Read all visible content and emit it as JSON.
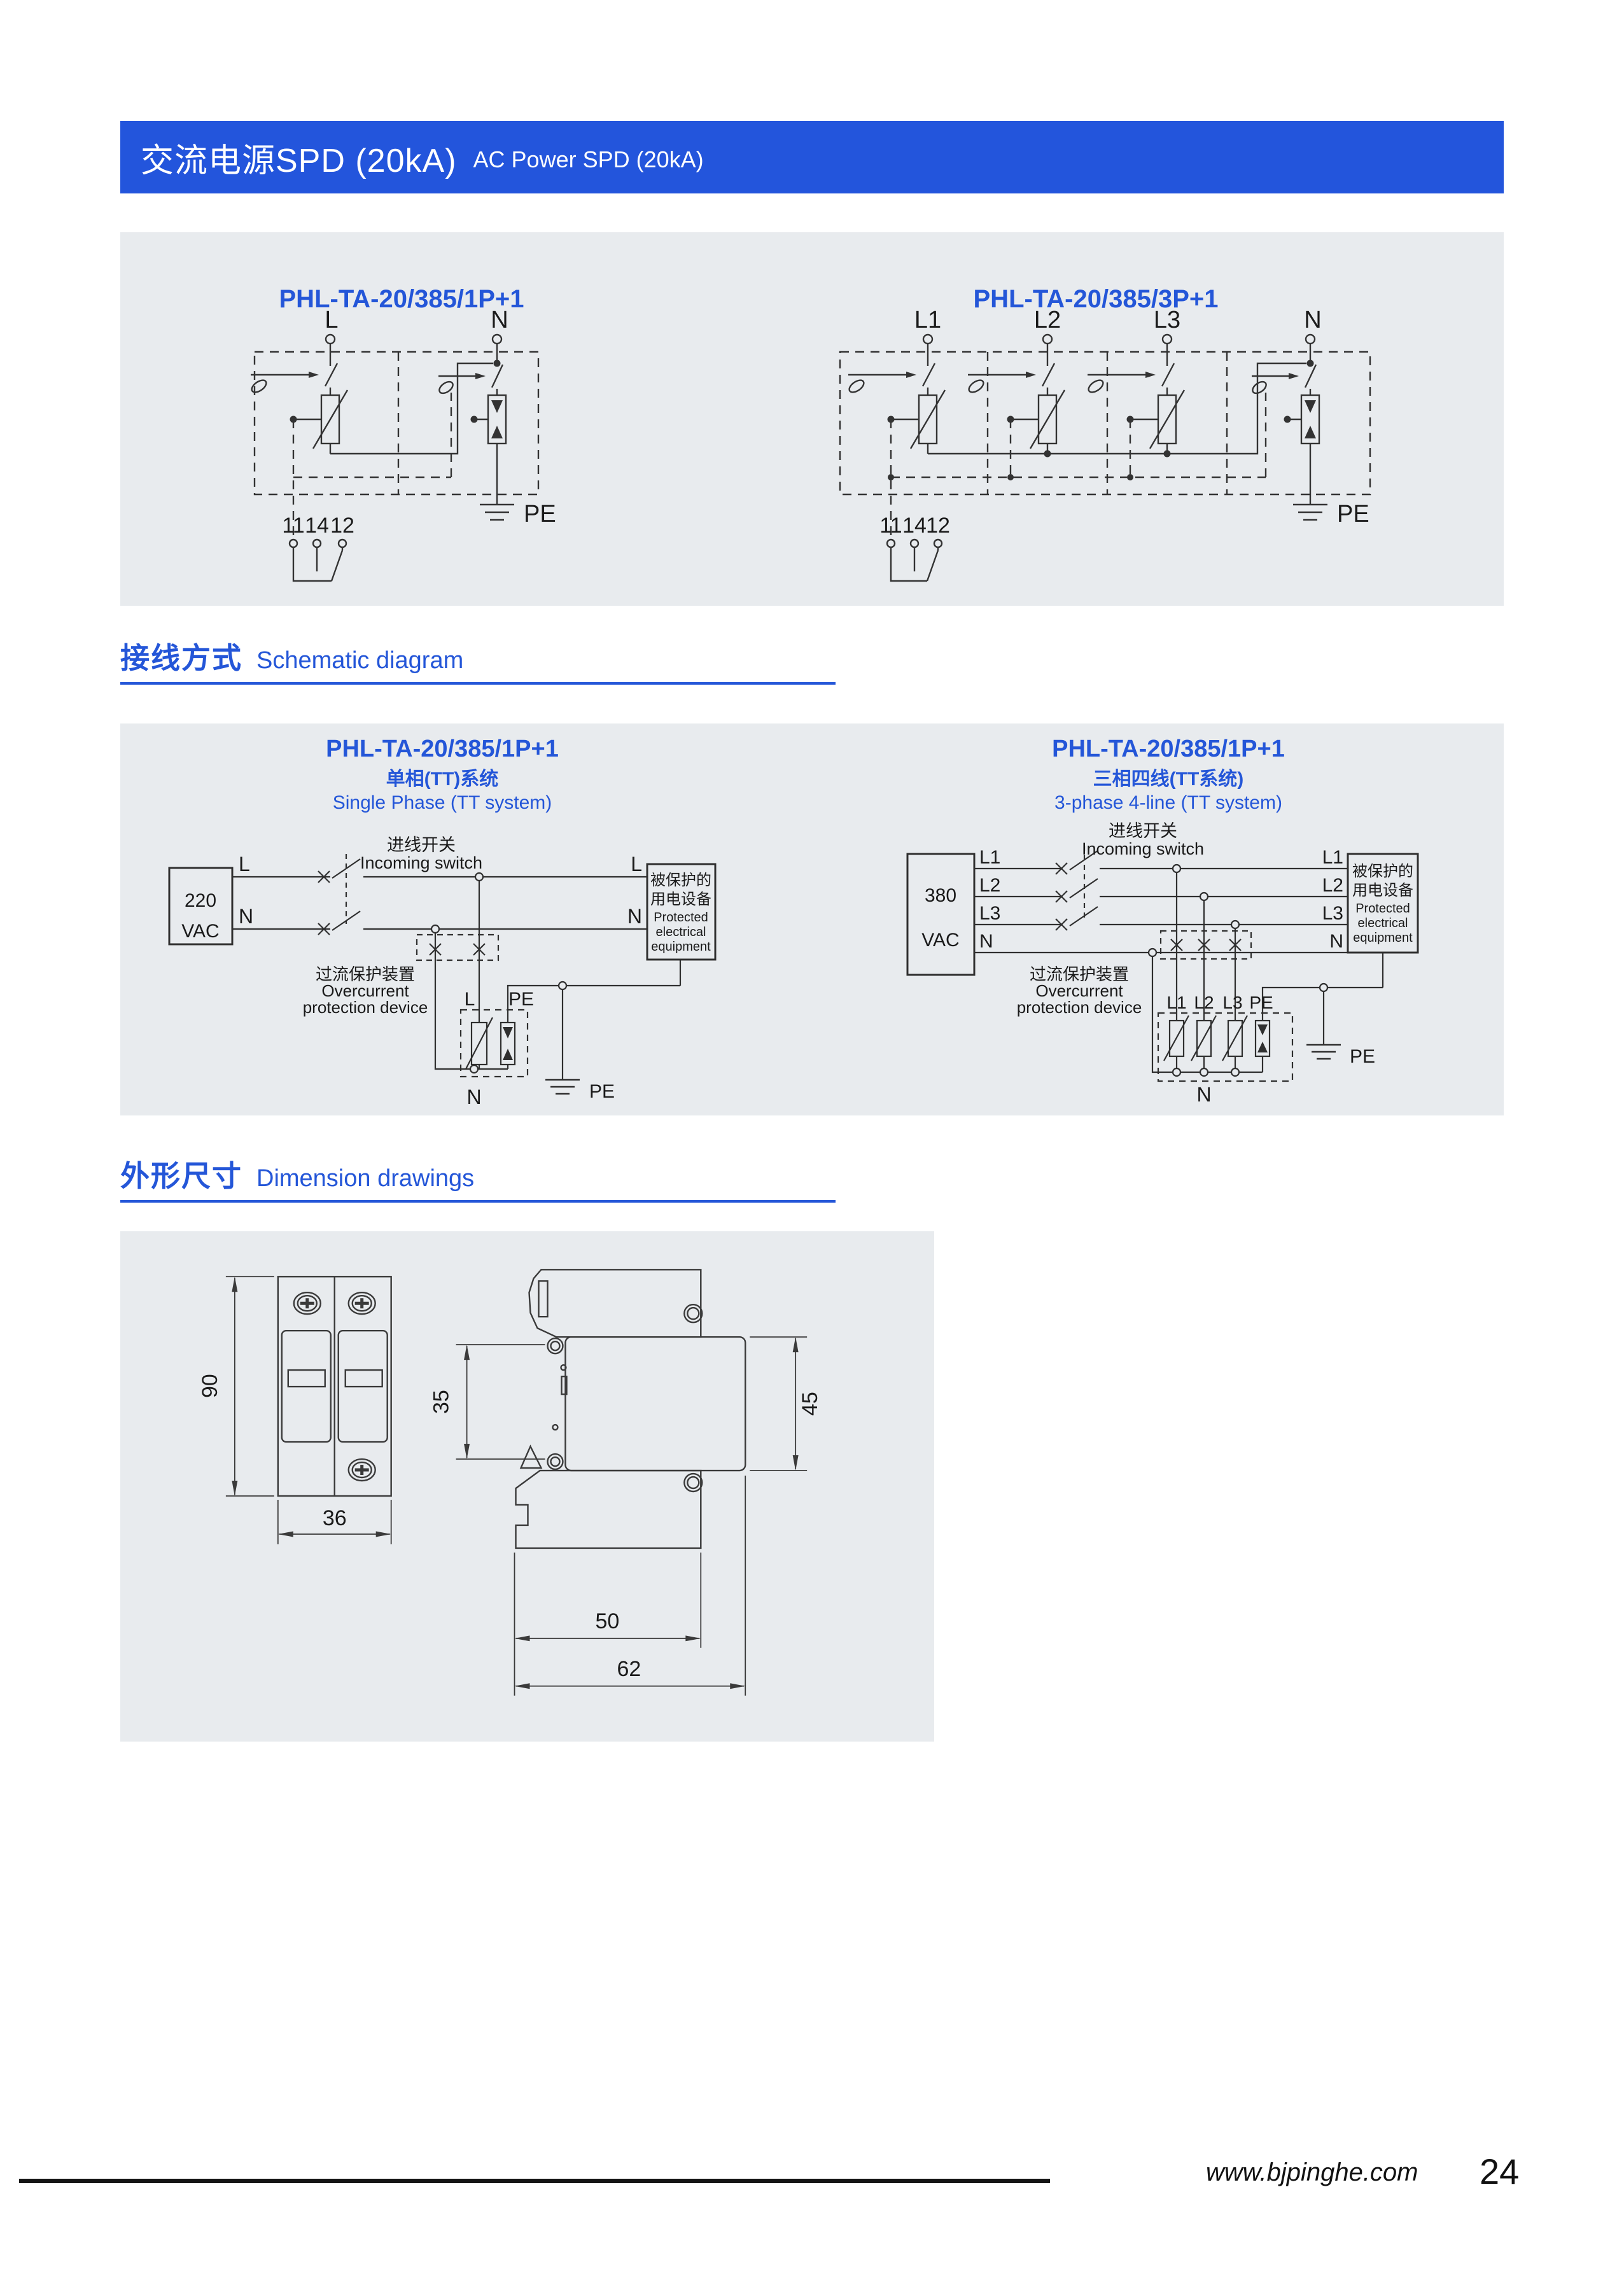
{
  "header": {
    "title_zh": "交流电源SPD (20kA)",
    "title_en": "AC Power SPD (20kA)"
  },
  "sections": {
    "wiring": {
      "zh": "接线方式",
      "en": "Schematic diagram"
    },
    "dims": {
      "zh": "外形尺寸",
      "en": "Dimension drawings"
    }
  },
  "footer": {
    "website": "www.bjpinghe.com",
    "page_number": "24"
  },
  "circuit1": {
    "title": "PHL-TA-20/385/1P+1",
    "l": "L",
    "n": "N",
    "pe": "PE",
    "t11": "11",
    "t14": "14",
    "t12": "12"
  },
  "circuit2": {
    "title": "PHL-TA-20/385/3P+1",
    "l1": "L1",
    "l2": "L2",
    "l3": "L3",
    "n": "N",
    "pe": "PE",
    "t11": "11",
    "t14": "14",
    "t12": "12"
  },
  "schematic1": {
    "title": "PHL-TA-20/385/1P+1",
    "subtitle_zh": "单相(TT)系统",
    "subtitle_en": "Single Phase (TT system)",
    "voltage": "220",
    "voltage_unit": "VAC",
    "incoming_zh": "进线开关",
    "incoming_en": "Incoming switch",
    "overcurrent_zh": "过流保护装置",
    "overcurrent_en1": "Overcurrent",
    "overcurrent_en2": "protection device",
    "protected_zh1": "被保护的",
    "protected_zh2": "用电设备",
    "protected_en1": "Protected",
    "protected_en2": "electrical",
    "protected_en3": "equipment",
    "l": "L",
    "n": "N",
    "pe": "PE",
    "spd_l": "L",
    "spd_pe": "PE",
    "spd_n": "N"
  },
  "schematic2": {
    "title": "PHL-TA-20/385/1P+1",
    "subtitle_zh": "三相四线(TT系统)",
    "subtitle_en": "3-phase 4-line (TT system)",
    "voltage": "380",
    "voltage_unit": "VAC",
    "incoming_zh": "进线开关",
    "incoming_en": "Incoming switch",
    "overcurrent_zh": "过流保护装置",
    "overcurrent_en1": "Overcurrent",
    "overcurrent_en2": "protection device",
    "protected_zh1": "被保护的",
    "protected_zh2": "用电设备",
    "protected_en1": "Protected",
    "protected_en2": "electrical",
    "protected_en3": "equipment",
    "l1": "L1",
    "l2": "L2",
    "l3": "L3",
    "n": "N",
    "pe": "PE",
    "spd_l1": "L1",
    "spd_l2": "L2",
    "spd_l3": "L3",
    "spd_pe": "PE",
    "spd_n": "N"
  },
  "dimensions": {
    "height": "90",
    "width": "36",
    "side_left": "35",
    "side_right": "45",
    "depth_inner": "50",
    "depth_outer": "62"
  },
  "colors": {
    "accent": "#2456D8",
    "panel_bg": "#E8EBEE"
  }
}
